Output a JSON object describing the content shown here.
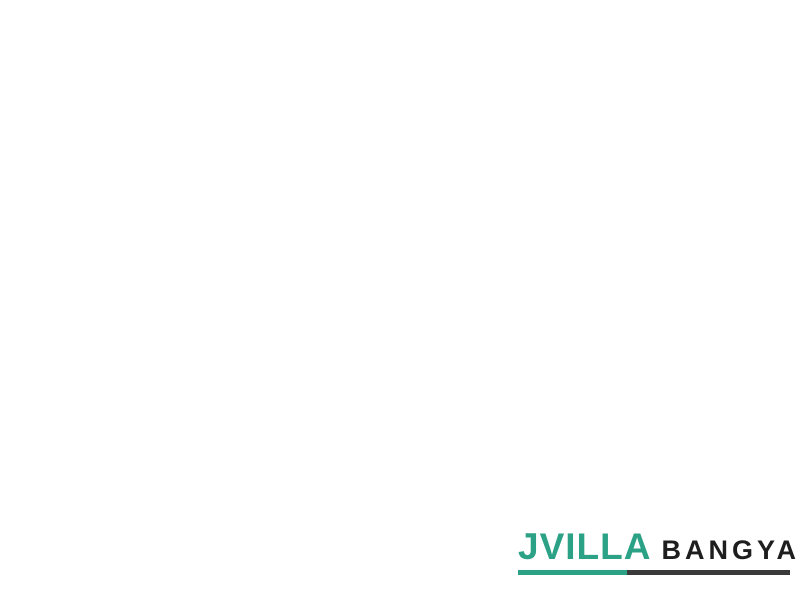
{
  "logo": {
    "brand": "JVILLA",
    "suffix": "BANGYAI",
    "brand_color": "#2ba185",
    "suffix_color": "#1e1e1e",
    "underline_left_color": "#2ba185",
    "underline_right_color": "#3a3a3a",
    "underline_split": "40%"
  },
  "palette": {
    "background": "#ffffff",
    "road": "#8e8e8e",
    "road_speck_dark": "#6c6c6c",
    "road_speck_light": "#a6a6a6",
    "sidewalk": "#d4d4d4",
    "mint": "#9fe4c2",
    "mint_stroke": "#2f7b5b",
    "teal": "#3fbcb4",
    "teal_stroke": "#1c6e67",
    "plot_mark": "#214d3d",
    "tree_dark": "#2f5c13",
    "tree": "#4e7f1d",
    "tree_mid": "#6fa32e",
    "tree_light": "#8fbf4e",
    "park_ground": "#aac77f",
    "pool_water": "#7fd0e4",
    "pool_deck": "#edece6",
    "building": "#b5ae9d",
    "island": "#6d9c35",
    "island_inner": "#93bb5c",
    "arc_line": "#787878"
  },
  "site_plan": {
    "outline": [
      [
        165,
        38
      ],
      [
        213,
        100
      ],
      [
        270,
        143
      ],
      [
        338,
        192
      ],
      [
        398,
        242
      ],
      [
        470,
        260
      ],
      [
        560,
        279
      ],
      [
        660,
        298
      ],
      [
        792,
        322
      ],
      [
        763,
        458
      ],
      [
        640,
        441
      ],
      [
        520,
        416
      ],
      [
        433,
        396
      ],
      [
        429,
        360
      ],
      [
        400,
        374
      ],
      [
        372,
        366
      ],
      [
        344,
        362
      ],
      [
        307,
        336
      ],
      [
        262,
        317
      ],
      [
        222,
        308
      ],
      [
        150,
        284
      ],
      [
        100,
        269
      ],
      [
        58,
        268
      ],
      [
        60,
        196
      ],
      [
        80,
        130
      ],
      [
        118,
        122
      ]
    ],
    "entrance": {
      "arc_center": [
        153,
        98
      ],
      "arc_radii": [
        16,
        28,
        40
      ],
      "island": {
        "cx": 131,
        "cy": 101,
        "rx": 14,
        "ry": 22,
        "rot": -35
      },
      "guard_rects": [
        [
          150,
          133,
          20,
          11,
          38
        ],
        [
          163,
          150,
          16,
          9,
          38
        ]
      ],
      "guard_trees": [
        [
          128,
          142,
          6
        ],
        [
          176,
          130,
          6
        ],
        [
          188,
          152,
          5
        ]
      ]
    },
    "park": {
      "polygon": [
        [
          72,
          128
        ],
        [
          152,
          132
        ],
        [
          180,
          170
        ],
        [
          168,
          212
        ],
        [
          150,
          240
        ],
        [
          120,
          252
        ],
        [
          62,
          252
        ],
        [
          60,
          190
        ]
      ],
      "trees": [
        [
          80,
          140,
          8,
          1
        ],
        [
          97,
          134,
          9,
          2
        ],
        [
          114,
          142,
          8,
          0
        ],
        [
          131,
          149,
          7,
          1
        ],
        [
          88,
          155,
          10,
          2
        ],
        [
          109,
          158,
          9,
          1
        ],
        [
          127,
          163,
          8,
          0
        ],
        [
          143,
          161,
          6,
          2
        ],
        [
          75,
          172,
          8,
          1
        ],
        [
          96,
          176,
          9,
          0
        ],
        [
          116,
          179,
          8,
          2
        ],
        [
          135,
          181,
          7,
          1
        ],
        [
          152,
          172,
          6,
          0
        ],
        [
          70,
          191,
          7,
          2
        ],
        [
          140,
          196,
          7,
          1
        ],
        [
          154,
          202,
          6,
          0
        ],
        [
          67,
          211,
          7,
          1
        ],
        [
          131,
          216,
          7,
          2
        ],
        [
          146,
          223,
          6,
          1
        ],
        [
          69,
          229,
          6,
          0
        ],
        [
          90,
          241,
          7,
          1
        ],
        [
          110,
          239,
          6,
          2
        ],
        [
          128,
          236,
          6,
          1
        ],
        [
          66,
          248,
          5,
          2
        ],
        [
          141,
          245,
          5,
          0
        ]
      ]
    },
    "pool": {
      "deck": [
        100,
        205,
        40,
        30,
        30
      ],
      "water": [
        100,
        202,
        28,
        15,
        30
      ],
      "building": [
        97,
        224,
        30,
        12,
        30
      ],
      "path": [
        118,
        232,
        16,
        6,
        30
      ]
    },
    "blocks": [
      [
        190,
        174,
        40,
        56,
        38,
        "m",
        2,
        4
      ],
      [
        236,
        201,
        40,
        58,
        38,
        "m",
        2,
        4
      ],
      [
        284,
        228,
        42,
        58,
        38,
        "m",
        2,
        4
      ],
      [
        331,
        256,
        42,
        58,
        38,
        "m",
        2,
        4
      ],
      [
        380,
        298,
        36,
        84,
        22,
        "m",
        2,
        6
      ],
      [
        418,
        310,
        36,
        86,
        14,
        "m",
        2,
        6
      ],
      [
        171,
        243,
        36,
        78,
        38,
        "t",
        2,
        5
      ],
      [
        206,
        264,
        36,
        78,
        38,
        "t",
        2,
        5
      ],
      [
        247,
        289,
        38,
        52,
        38,
        "m",
        2,
        4
      ],
      [
        285,
        311,
        36,
        48,
        38,
        "t",
        2,
        3
      ],
      [
        326,
        340,
        38,
        46,
        38,
        "t",
        2,
        3
      ],
      [
        387,
        361,
        26,
        26,
        20,
        "t",
        1,
        2
      ],
      [
        78,
        250,
        42,
        28,
        16,
        "m",
        3,
        1
      ],
      [
        117,
        262,
        30,
        22,
        14,
        "m",
        2,
        1
      ]
    ],
    "upper_strip": [
      [
        437,
        274
      ],
      [
        520,
        292
      ],
      [
        610,
        310
      ],
      [
        700,
        329
      ],
      [
        786,
        346
      ],
      [
        770,
        420
      ],
      [
        700,
        405
      ],
      [
        610,
        388
      ],
      [
        520,
        371
      ],
      [
        437,
        358
      ]
    ],
    "lower_strip": [
      [
        435,
        372
      ],
      [
        520,
        390
      ],
      [
        610,
        408
      ],
      [
        700,
        424
      ],
      [
        762,
        438
      ],
      [
        763,
        457
      ],
      [
        700,
        446
      ],
      [
        610,
        428
      ],
      [
        520,
        411
      ],
      [
        433,
        396
      ]
    ],
    "strip_midlines": [
      [
        [
          437,
          316
        ],
        [
          610,
          349
        ],
        [
          786,
          383
        ]
      ],
      [
        [
          434,
          384
        ],
        [
          610,
          418
        ],
        [
          762,
          447
        ]
      ]
    ],
    "stubs_up": {
      "pts": [
        [
          452,
          358
        ],
        [
          498,
          367
        ],
        [
          544,
          377
        ],
        [
          590,
          385
        ],
        [
          636,
          393
        ],
        [
          682,
          401
        ],
        [
          728,
          410
        ]
      ],
      "len": 70,
      "w": 13,
      "tilt": 11
    },
    "stubs_down": {
      "pts": [
        [
          475,
          378
        ],
        [
          521,
          387
        ],
        [
          567,
          396
        ],
        [
          613,
          404
        ],
        [
          659,
          412
        ],
        [
          705,
          420
        ],
        [
          748,
          428
        ]
      ],
      "len": 24,
      "w": 13,
      "tilt": 11
    },
    "tree_rows": [
      {
        "pts": [
          [
            172,
            55
          ],
          [
            240,
            117
          ],
          [
            310,
            171
          ],
          [
            398,
            240
          ]
        ],
        "step": 14,
        "r": 4.5
      },
      {
        "pts": [
          [
            412,
            244
          ],
          [
            788,
            317
          ]
        ],
        "step": 14,
        "r": 4.5
      },
      {
        "pts": [
          [
            432,
            272
          ],
          [
            782,
            342
          ]
        ],
        "step": 14,
        "r": 4
      }
    ],
    "bushes": [
      [
        178,
        150
      ],
      [
        190,
        157
      ],
      [
        202,
        163
      ],
      [
        224,
        177
      ],
      [
        236,
        183
      ],
      [
        248,
        189
      ],
      [
        272,
        204
      ],
      [
        284,
        210
      ],
      [
        296,
        216
      ],
      [
        319,
        232
      ],
      [
        331,
        238
      ],
      [
        343,
        244
      ]
    ],
    "road_trees": [
      [
        154,
        188,
        6
      ],
      [
        362,
        282,
        6
      ],
      [
        374,
        290,
        5
      ]
    ],
    "mid_park": {
      "polygon": [
        [
          341,
          337
        ],
        [
          376,
          341
        ],
        [
          372,
          367
        ],
        [
          343,
          362
        ]
      ],
      "trees": [
        [
          350,
          346,
          5,
          1
        ],
        [
          363,
          350,
          5,
          2
        ],
        [
          356,
          358,
          5,
          0
        ],
        [
          368,
          360,
          4,
          1
        ]
      ]
    }
  }
}
